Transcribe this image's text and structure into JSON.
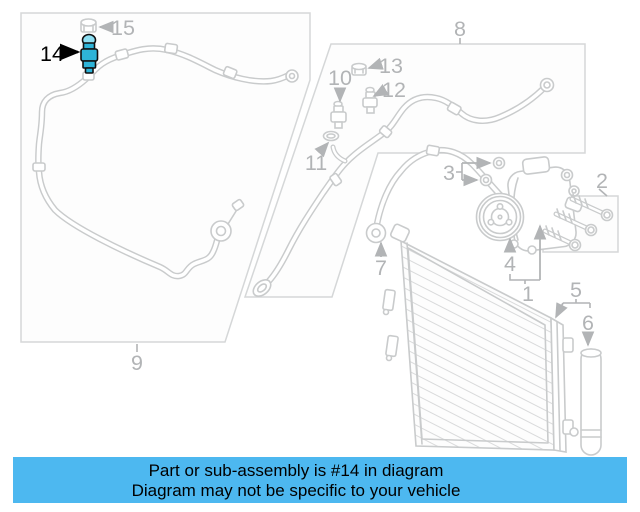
{
  "banner": {
    "line1": "Part or sub-assembly is #14 in diagram",
    "line2": "Diagram may not be specific to your vehicle"
  },
  "diagram": {
    "highlighted_part_number": "14",
    "callouts": [
      {
        "number": "15",
        "x": 123,
        "y": 35,
        "style": "gray"
      },
      {
        "number": "14",
        "x": 52,
        "y": 61,
        "style": "black"
      },
      {
        "number": "8",
        "x": 460,
        "y": 36,
        "style": "gray"
      },
      {
        "number": "13",
        "x": 391,
        "y": 73,
        "style": "gray"
      },
      {
        "number": "12",
        "x": 394,
        "y": 97,
        "style": "gray"
      },
      {
        "number": "10",
        "x": 340,
        "y": 85,
        "style": "gray"
      },
      {
        "number": "11",
        "x": 316,
        "y": 170,
        "style": "gray"
      },
      {
        "number": "9",
        "x": 137,
        "y": 370,
        "style": "gray"
      },
      {
        "number": "7",
        "x": 381,
        "y": 275,
        "style": "gray"
      },
      {
        "number": "3",
        "x": 449,
        "y": 180,
        "style": "gray"
      },
      {
        "number": "2",
        "x": 602,
        "y": 188,
        "style": "gray"
      },
      {
        "number": "4",
        "x": 510,
        "y": 271,
        "style": "gray"
      },
      {
        "number": "1",
        "x": 528,
        "y": 301,
        "style": "gray"
      },
      {
        "number": "5",
        "x": 576,
        "y": 297,
        "style": "gray"
      },
      {
        "number": "6",
        "x": 588,
        "y": 330,
        "style": "gray"
      }
    ]
  },
  "colors": {
    "background": "#ffffff",
    "line-gray": "#c9cbcc",
    "label-gray": "#b2b4b6",
    "box-stroke": "#d5d7d8",
    "box-fill": "#fdfdfd",
    "hatch": "#d9dadb",
    "banner-bg": "#4db8f0",
    "banner-text": "#000000",
    "highlight": "#2eb4d8",
    "highlight-light": "#8edff2",
    "highlight-stroke": "#101010"
  }
}
